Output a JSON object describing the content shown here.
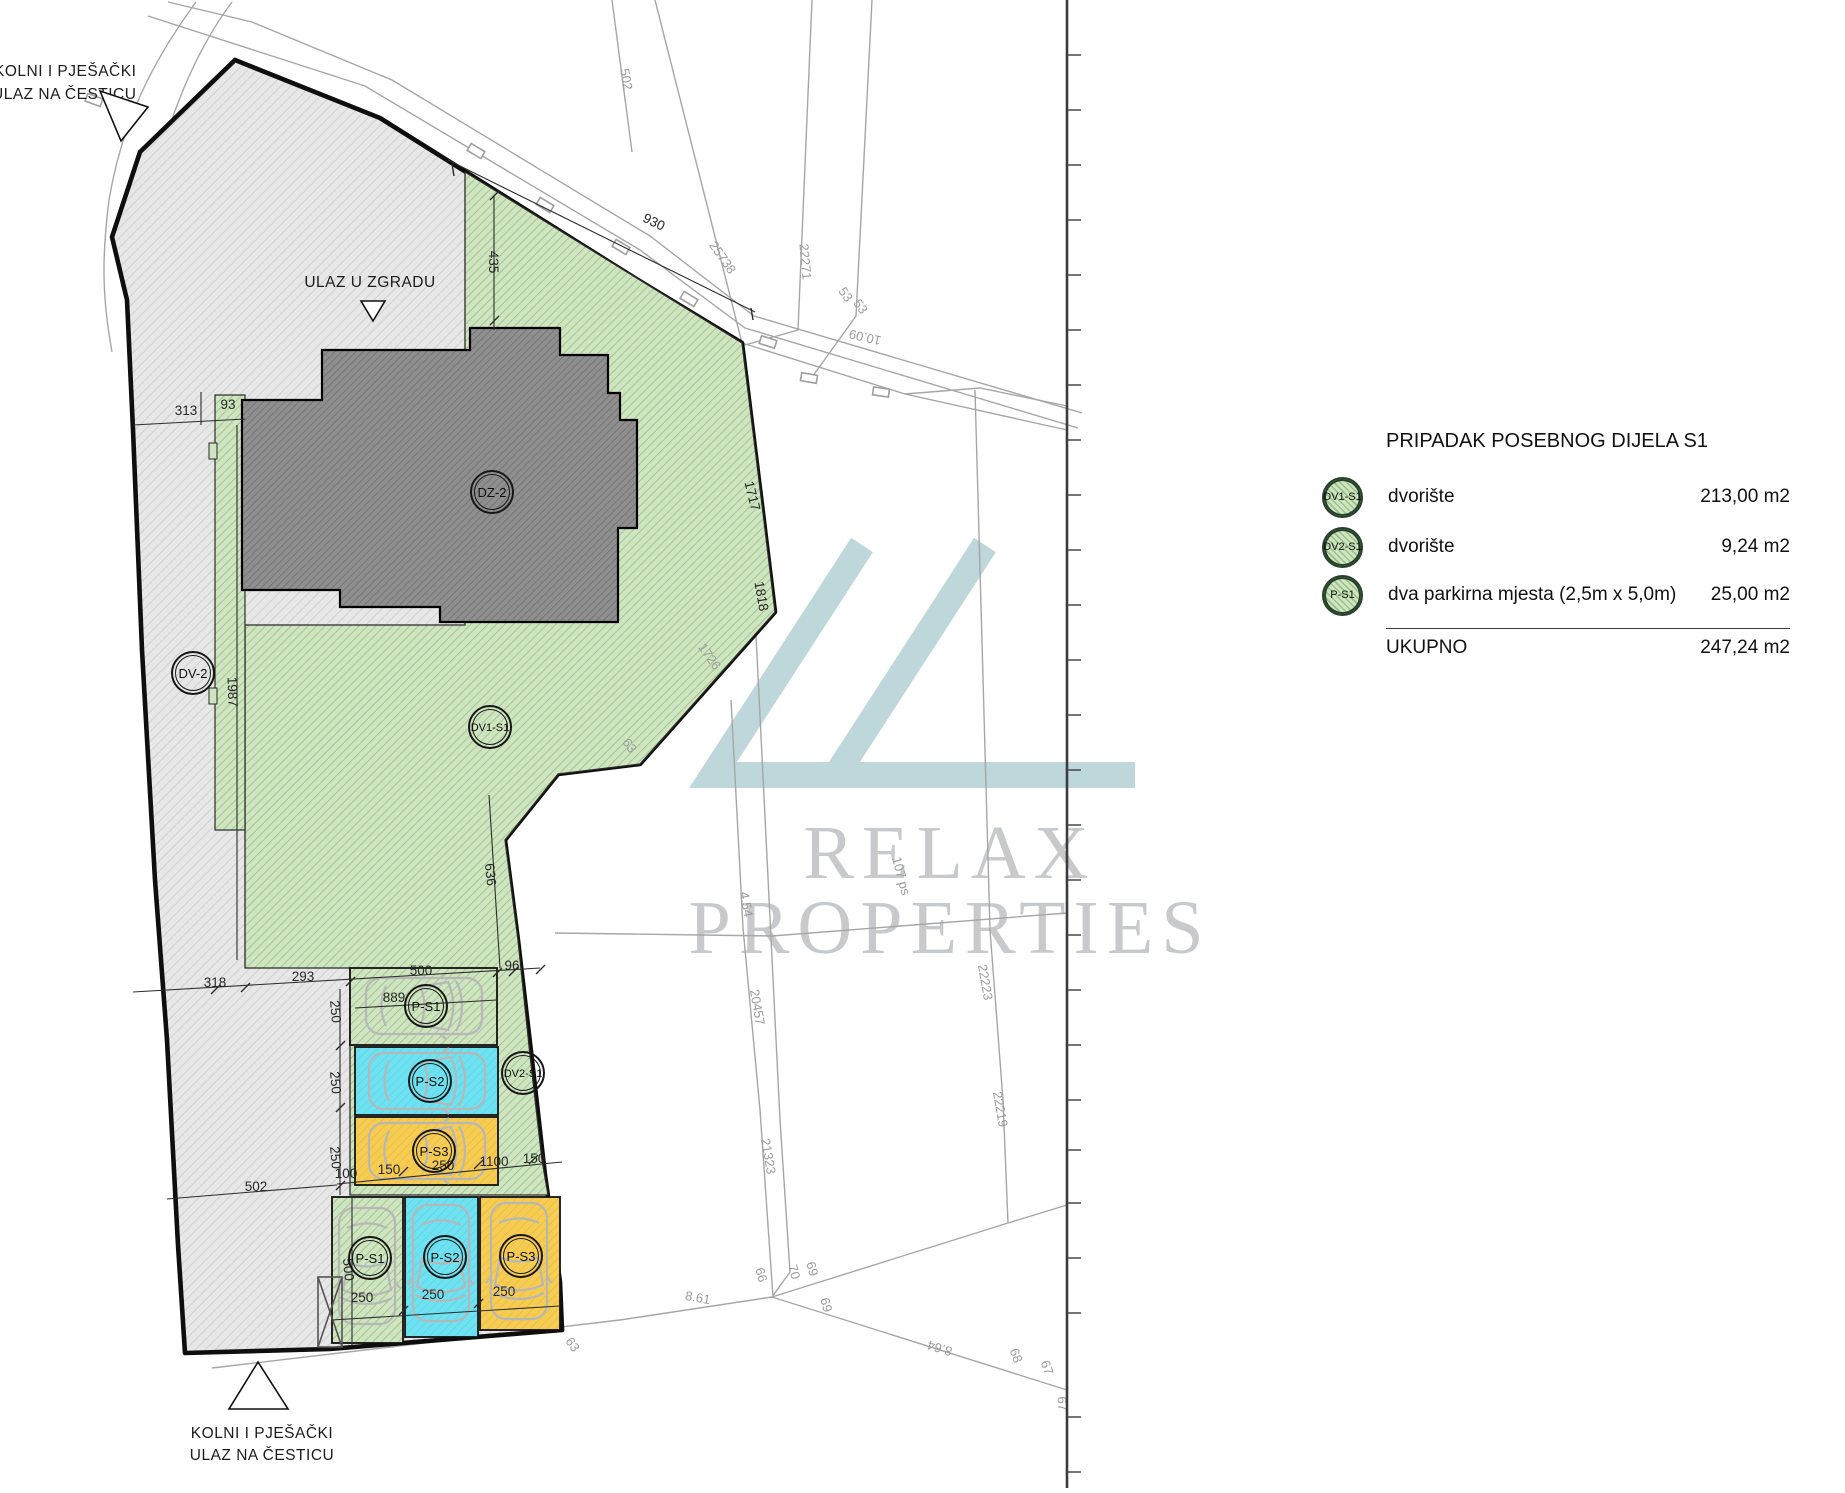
{
  "plan": {
    "annotations": {
      "entrance_top_line1": "KOLNI I PJEŠAČKI",
      "entrance_top_line2": "ULAZ NA ČESTICU",
      "building_entrance": "ULAZ U ZGRADU",
      "entrance_bottom_line1": "KOLNI I PJEŠAČKI",
      "entrance_bottom_line2": "ULAZ NA ČESTICU"
    },
    "zone_labels": {
      "building": "DZ-2",
      "driveway": "DV-2",
      "yard1": "DV1-S1",
      "yard2": "DV2-S1",
      "p1": "P-S1",
      "p2": "P-S2",
      "p3": "P-S3"
    },
    "dims": [
      "313",
      "93",
      "435",
      "930",
      "1987",
      "636",
      "1717",
      "1818",
      "318",
      "293",
      "500",
      "96",
      "889",
      "250",
      "250",
      "250",
      "100",
      "150",
      "250",
      "1100",
      "150",
      "502",
      "500",
      "250",
      "250",
      "250"
    ],
    "cadastral": [
      "502",
      "25738",
      "22271",
      "53",
      "53",
      "10.09",
      "1726",
      "63",
      "4.54",
      "107 ps",
      "22223",
      "20457",
      "21323",
      "22219",
      "66",
      "70",
      "69",
      "69",
      "8.61",
      "63",
      "8.64",
      "68",
      "67",
      "67"
    ]
  },
  "watermark": {
    "line1": "RELAX",
    "line2": "PROPERTIES"
  },
  "legend": {
    "title": "PRIPADAK POSEBNOG DIJELA S1",
    "rows": [
      {
        "badge": "DV1-S1",
        "desc": "dvorište",
        "value": "213,00 m2"
      },
      {
        "badge": "DV2-S1",
        "desc": "dvorište",
        "value": "9,24 m2"
      },
      {
        "badge": "P-S1",
        "desc": "dva parkirna mjesta (2,5m x 5,0m)",
        "value": "25,00 m2"
      }
    ],
    "total_label": "UKUPNO",
    "total_value": "247,24 m2"
  }
}
